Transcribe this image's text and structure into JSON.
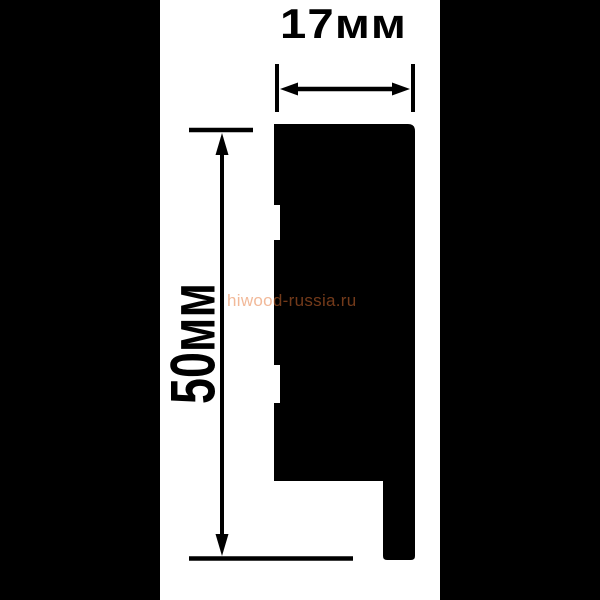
{
  "drawing": {
    "type": "skirting-board-profile-cross-section",
    "dims": {
      "width_label": "17мм",
      "height_label": "50мм",
      "width_mm": 17,
      "height_mm": 50
    },
    "watermark": {
      "text": "hiwood-russia.ru",
      "color": "rgba(230,115,52,0.5)"
    },
    "colors": {
      "background": "#ffffff",
      "letterbox": "#000000",
      "profile": "#000000",
      "dimension": "#000000"
    }
  }
}
